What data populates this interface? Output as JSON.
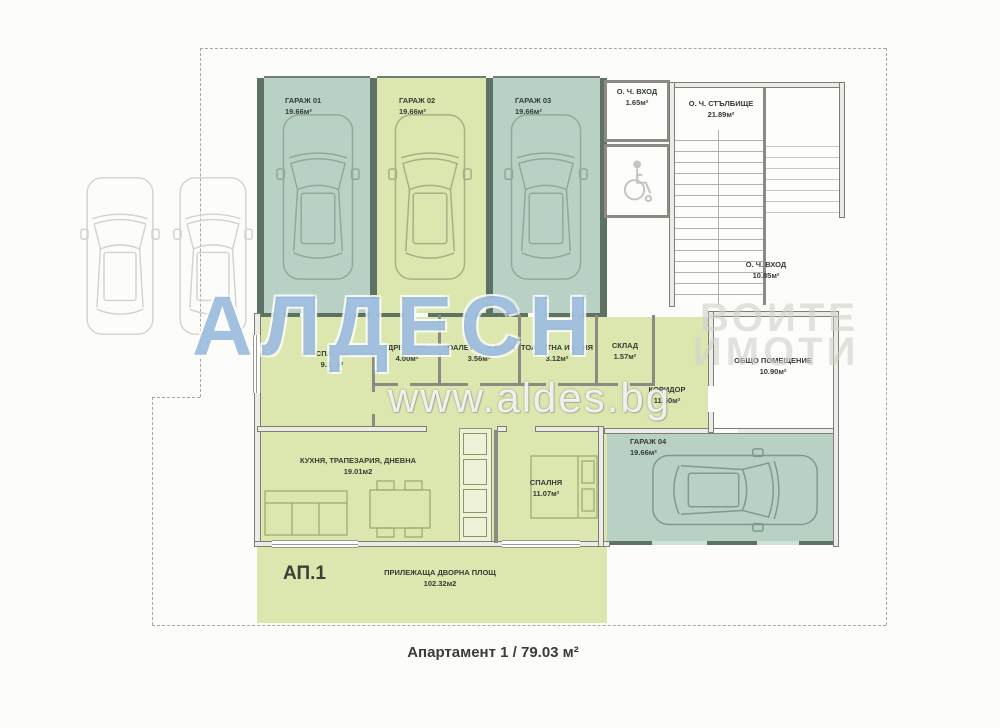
{
  "plan": {
    "footer_caption": "Апартамент 1 / 79.03 м²",
    "apartment_tag": "АП.1"
  },
  "watermark": {
    "brand": "АЛДЕС",
    "brand_partial": "Н",
    "right_line1": "ВОИТЕ",
    "right_line2": "ИМОТИ",
    "url": "www.aldes.bg"
  },
  "rooms": {
    "garage_01": {
      "name": "ГАРАЖ 01",
      "area": "19.66м²"
    },
    "garage_02": {
      "name": "ГАРАЖ 02",
      "area": "19.66м²"
    },
    "garage_03": {
      "name": "ГАРАЖ 03",
      "area": "19.66м²"
    },
    "garage_04": {
      "name": "ГАРАЖ 04",
      "area": "19.66м²"
    },
    "entry_small": {
      "name": "О. Ч. ВХОД",
      "area": "1.65м²"
    },
    "stairwell": {
      "name": "О. Ч. СТЪЛБИЩЕ",
      "area": "21.89м²"
    },
    "entry_main": {
      "name": "О. Ч. ВХОД",
      "area": "10.85м²"
    },
    "common_room": {
      "name": "ОБЩО ПОМЕЩЕНИЕ",
      "area": "10.90м²"
    },
    "bedroom_1": {
      "name": "СПАЛНЯ",
      "area": "9.15м²"
    },
    "closet": {
      "name": "ДРЕШНИК",
      "area": "4.00м²"
    },
    "bath_1": {
      "name": "ТОАЛЕТНА И БАНЯ",
      "area": "3.56м²"
    },
    "bath_2": {
      "name": "ТОАЛЕТНА И БАНЯ",
      "area": "3.12м²"
    },
    "storage": {
      "name": "СКЛАД",
      "area": "1.57м²"
    },
    "corridor": {
      "name": "КОРИДОР",
      "area": "11.60м²"
    },
    "living": {
      "name": "КУХНЯ, ТРАПЕЗАРИЯ, ДНЕВНА",
      "area": "19.01м2"
    },
    "bedroom_2": {
      "name": "СПАЛНЯ",
      "area": "11.07м²"
    },
    "yard": {
      "name": "ПРИЛЕЖАЩА ДВОРНА ПЛОЩ",
      "area": "102.32м2"
    }
  },
  "colors": {
    "garage_teal": "#b9d0c5",
    "apartment_green": "#dbe7ae",
    "wall_dark": "#5d7265",
    "watermark_blue": "#4d86c2"
  }
}
